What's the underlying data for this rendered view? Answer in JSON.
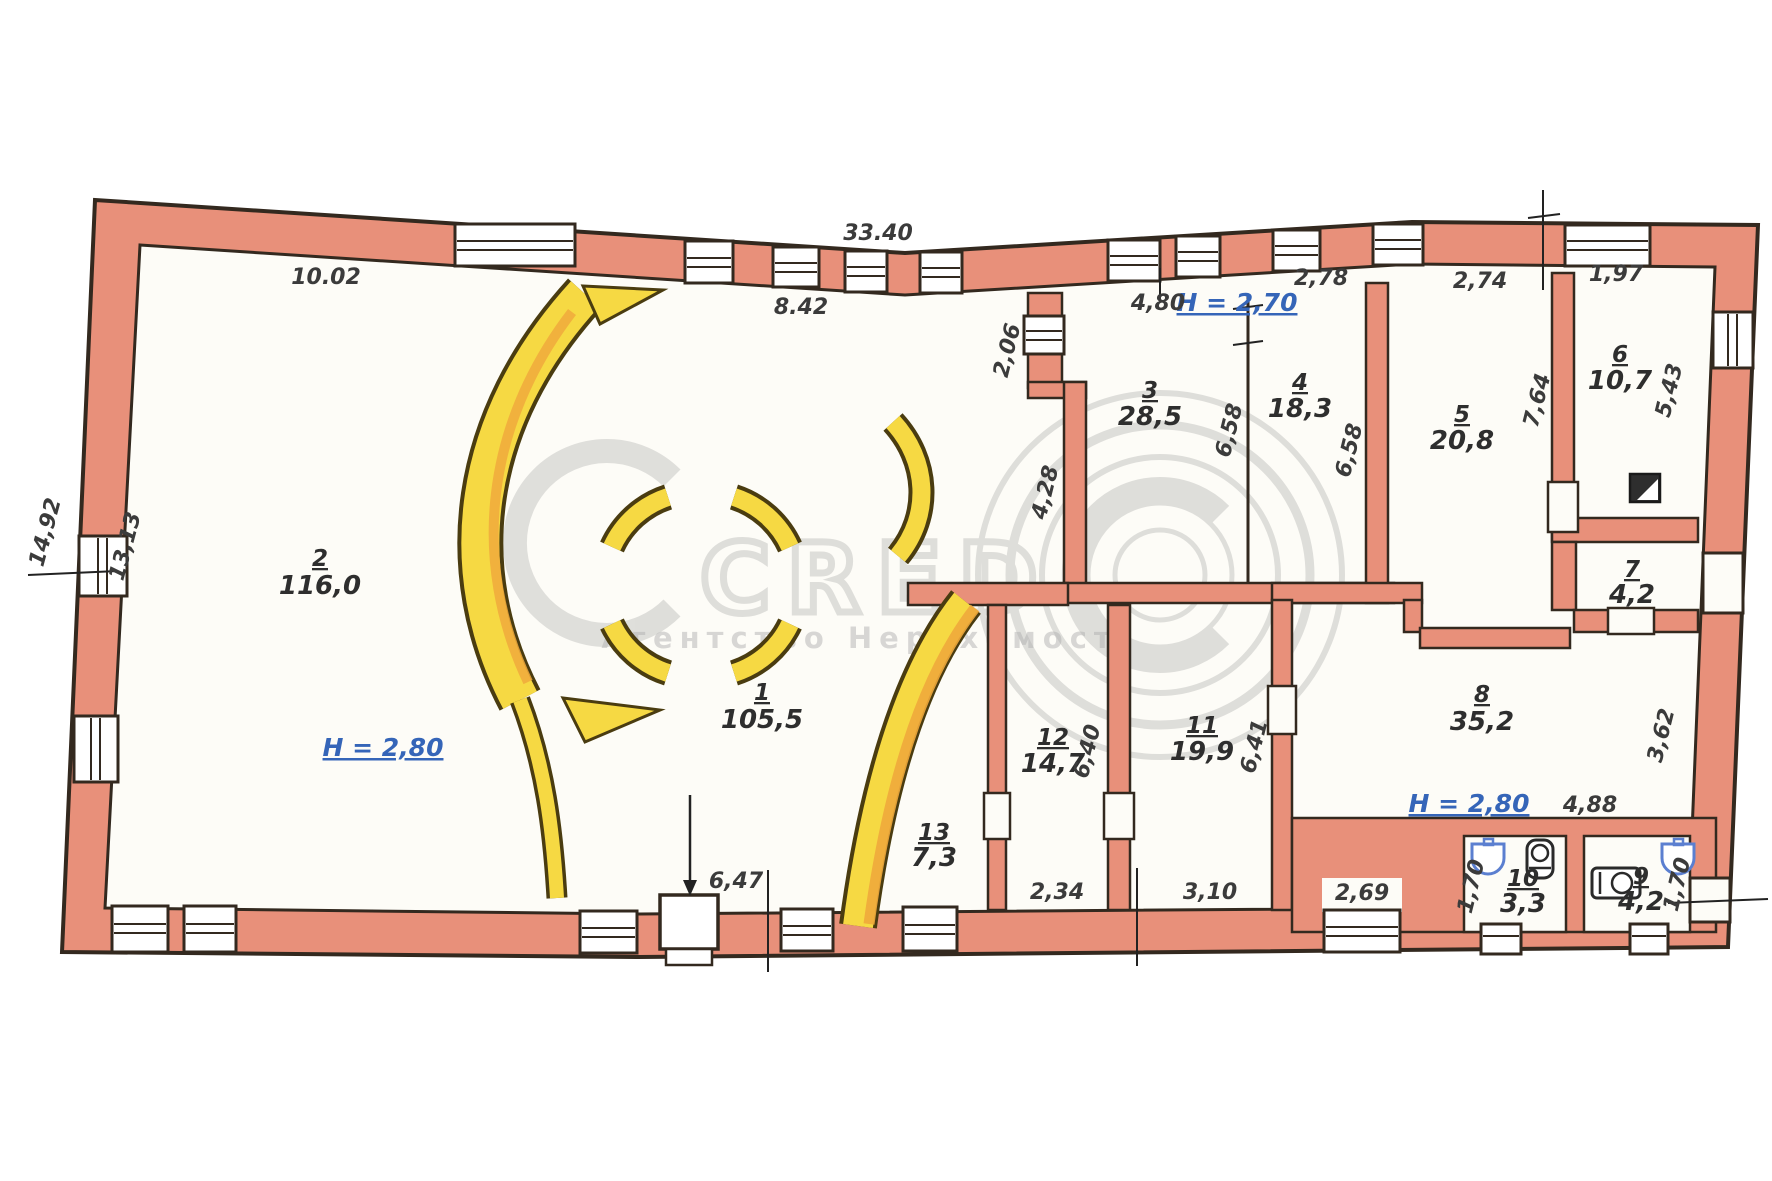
{
  "watermark": {
    "brand": "CRED",
    "agency": "Агентство Нерухомості"
  },
  "rooms": {
    "r1": {
      "num": "1",
      "area": "105,5"
    },
    "r2": {
      "num": "2",
      "area": "116,0"
    },
    "r3": {
      "num": "3",
      "area": "28,5"
    },
    "r4": {
      "num": "4",
      "area": "18,3"
    },
    "r5": {
      "num": "5",
      "area": "20,8"
    },
    "r6": {
      "num": "6",
      "area": "10,7"
    },
    "r7": {
      "num": "7",
      "area": "4,2"
    },
    "r8": {
      "num": "8",
      "area": "35,2"
    },
    "r9": {
      "num": "9",
      "area": "4,2"
    },
    "r10": {
      "num": "10",
      "area": "3,3"
    },
    "r11": {
      "num": "11",
      "area": "19,9"
    },
    "r12": {
      "num": "12",
      "area": "14,7"
    },
    "r13": {
      "num": "13",
      "area": "7,3"
    }
  },
  "heights": {
    "top": "H = 2,70",
    "room2": "H = 2,80",
    "room8": "H = 2,80"
  },
  "dims": {
    "overall_top": "33.40",
    "top_left": "10.02",
    "top_mid": "8.42",
    "room3_w": "4,80",
    "room4_w": "2,78",
    "room5_w": "2,74",
    "room6_w": "1,97",
    "left_outer": "14,92",
    "left_inner": "13,13",
    "vest_d": "2,06",
    "hall_d": "4,28",
    "room34_h": "6,58",
    "room5_hl": "6,58",
    "room5_hr": "7,64",
    "room6_h": "5,43",
    "right_mid": "3,62",
    "room12_h": "6,40",
    "room11_h": "6,41",
    "bottom_left": "6,47",
    "room12_w": "2,34",
    "room11_w": "3,10",
    "bottom_mid": "2,69",
    "room8_w": "4,88",
    "room10_h": "1,70",
    "room9_h": "1,70"
  },
  "colors": {
    "wall": "#e8907a",
    "yellow": "#f6d943",
    "orange": "#f0a93c",
    "outline": "#33291f",
    "height_blue": "#3565b8",
    "fixture_blue": "#5b7fd0",
    "watermark_gray": "#8a8a8a"
  }
}
